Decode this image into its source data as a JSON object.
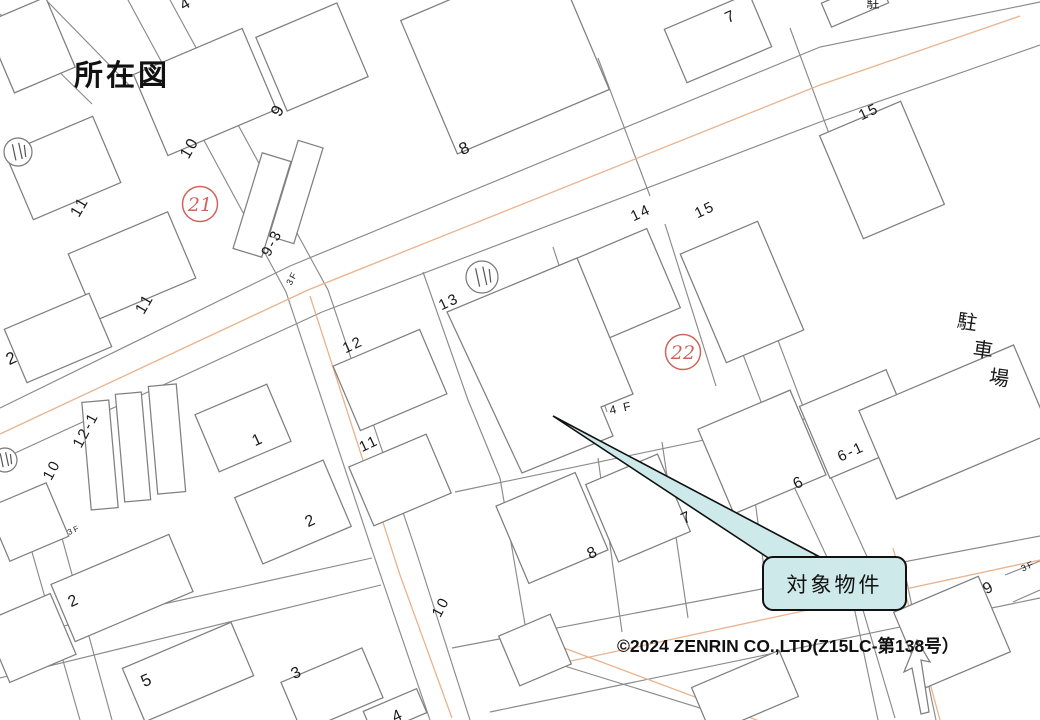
{
  "title": "所在図",
  "copyright": "©2024 ZENRIN CO.,LTD(Z15LC-第138号）",
  "callout": {
    "label": "対象物件",
    "box": {
      "x": 762,
      "y": 556,
      "w": 141,
      "h": 51
    },
    "arrow": [
      [
        553,
        416
      ],
      [
        818,
        556
      ],
      [
        776,
        563
      ]
    ]
  },
  "colors": {
    "line": "#8a8a8a",
    "building": "#7f7f7f",
    "road_center": "#e8b38e",
    "red": "#d0635a",
    "label": "#1a1a1a",
    "callout_fill": "#cde9e9"
  },
  "red_circles": [
    {
      "label": "21",
      "x": 200,
      "y": 204
    },
    {
      "label": "22",
      "x": 683,
      "y": 352
    }
  ],
  "symbols": [
    {
      "x": 18,
      "y": 152,
      "r": 14
    },
    {
      "x": 5,
      "y": 460,
      "r": 12
    },
    {
      "x": 482,
      "y": 277,
      "r": 16
    }
  ],
  "labels": [
    {
      "t": "4",
      "x": 186,
      "y": 4,
      "r": -30,
      "s": 16
    },
    {
      "t": "9",
      "x": 278,
      "y": 110,
      "r": -60,
      "s": 17
    },
    {
      "t": "10",
      "x": 190,
      "y": 148,
      "r": -60,
      "s": 16
    },
    {
      "t": "11",
      "x": 80,
      "y": 207,
      "r": -60,
      "s": 16
    },
    {
      "t": "11",
      "x": 145,
      "y": 304,
      "r": -60,
      "s": 16
    },
    {
      "t": "9-3",
      "x": 272,
      "y": 243,
      "r": -62,
      "s": 15
    },
    {
      "t": "3F",
      "x": 292,
      "y": 278,
      "r": -62,
      "s": 9
    },
    {
      "t": "2",
      "x": 12,
      "y": 358,
      "r": -25,
      "s": 17
    },
    {
      "t": "8",
      "x": 465,
      "y": 148,
      "r": -25,
      "s": 17
    },
    {
      "t": "7",
      "x": 731,
      "y": 17,
      "r": -25,
      "s": 16
    },
    {
      "t": "駐",
      "x": 874,
      "y": 3,
      "r": 0,
      "s": 13
    },
    {
      "t": "15",
      "x": 869,
      "y": 112,
      "r": -25,
      "s": 15
    },
    {
      "t": "14",
      "x": 641,
      "y": 213,
      "r": -25,
      "s": 15
    },
    {
      "t": "15",
      "x": 705,
      "y": 210,
      "r": -25,
      "s": 15
    },
    {
      "t": "13",
      "x": 449,
      "y": 302,
      "r": -25,
      "s": 15
    },
    {
      "t": "12",
      "x": 353,
      "y": 345,
      "r": -25,
      "s": 15
    },
    {
      "t": "11",
      "x": 369,
      "y": 444,
      "r": -25,
      "s": 15
    },
    {
      "t": "4 F",
      "x": 621,
      "y": 408,
      "r": -12,
      "s": 12
    },
    {
      "t": "1",
      "x": 258,
      "y": 440,
      "r": -25,
      "s": 16
    },
    {
      "t": "12-1",
      "x": 86,
      "y": 430,
      "r": -62,
      "s": 15
    },
    {
      "t": "10",
      "x": 52,
      "y": 470,
      "r": -62,
      "s": 15
    },
    {
      "t": "3F",
      "x": 74,
      "y": 530,
      "r": -25,
      "s": 8
    },
    {
      "t": "2",
      "x": 311,
      "y": 521,
      "r": -25,
      "s": 16
    },
    {
      "t": "2",
      "x": 74,
      "y": 601,
      "r": -25,
      "s": 16
    },
    {
      "t": "5",
      "x": 147,
      "y": 680,
      "r": -25,
      "s": 17
    },
    {
      "t": "3",
      "x": 297,
      "y": 673,
      "r": -25,
      "s": 16
    },
    {
      "t": "4",
      "x": 398,
      "y": 716,
      "r": -25,
      "s": 16
    },
    {
      "t": "10",
      "x": 441,
      "y": 607,
      "r": -62,
      "s": 15
    },
    {
      "t": "8",
      "x": 593,
      "y": 553,
      "r": -25,
      "s": 16
    },
    {
      "t": "7",
      "x": 687,
      "y": 518,
      "r": -25,
      "s": 16
    },
    {
      "t": "6",
      "x": 799,
      "y": 483,
      "r": -25,
      "s": 16
    },
    {
      "t": "6-1",
      "x": 851,
      "y": 452,
      "r": -25,
      "s": 15
    },
    {
      "t": "9",
      "x": 989,
      "y": 588,
      "r": -28,
      "s": 16
    },
    {
      "t": "3F",
      "x": 1028,
      "y": 566,
      "r": -25,
      "s": 9
    },
    {
      "t": "駐",
      "x": 968,
      "y": 323,
      "r": 8,
      "s": 20
    },
    {
      "t": "車",
      "x": 984,
      "y": 351,
      "r": 8,
      "s": 20
    },
    {
      "t": "場",
      "x": 1000,
      "y": 379,
      "r": 8,
      "s": 20
    }
  ],
  "map": {
    "lines": [
      [
        [
          0,
          408
        ],
        [
          290,
          266
        ],
        [
          820,
          47
        ],
        [
          1040,
          2
        ]
      ],
      [
        [
          0,
          460
        ],
        [
          322,
          312
        ],
        [
          820,
          122
        ],
        [
          1040,
          45
        ]
      ],
      [
        [
          128,
          0
        ],
        [
          286,
          292
        ],
        [
          372,
          550
        ],
        [
          430,
          720
        ]
      ],
      [
        [
          170,
          0
        ],
        [
          328,
          290
        ],
        [
          415,
          548
        ],
        [
          470,
          720
        ]
      ],
      [
        [
          452,
          648
        ],
        [
          1040,
          536
        ]
      ],
      [
        [
          490,
          712
        ],
        [
          1040,
          598
        ]
      ],
      [
        [
          0,
          640
        ],
        [
          372,
          558
        ]
      ],
      [
        [
          0,
          678
        ],
        [
          381,
          585
        ]
      ],
      [
        [
          704,
          252
        ],
        [
          790,
          478
        ],
        [
          840,
          585
        ]
      ],
      [
        [
          740,
          240
        ],
        [
          824,
          462
        ],
        [
          874,
          572
        ]
      ],
      [
        [
          850,
          588
        ],
        [
          878,
          720
        ]
      ],
      [
        [
          906,
          578
        ],
        [
          936,
          720
        ]
      ],
      [
        [
          0,
          14
        ],
        [
          92,
          104
        ]
      ],
      [
        [
          46,
          0
        ],
        [
          132,
          88
        ]
      ],
      [
        [
          30,
          545
        ],
        [
          80,
          720
        ]
      ],
      [
        [
          62,
          538
        ],
        [
          112,
          720
        ]
      ],
      [
        [
          545,
          660
        ],
        [
          745,
          722
        ]
      ],
      [
        [
          423,
          272
        ],
        [
          468,
          400
        ],
        [
          500,
          478
        ]
      ],
      [
        [
          553,
          247
        ],
        [
          607,
          412
        ]
      ],
      [
        [
          665,
          224
        ],
        [
          716,
          386
        ]
      ],
      [
        [
          455,
          492
        ],
        [
          905,
          398
        ]
      ],
      [
        [
          500,
          478
        ],
        [
          528,
          642
        ]
      ],
      [
        [
          598,
          458
        ],
        [
          622,
          632
        ]
      ],
      [
        [
          662,
          442
        ],
        [
          688,
          618
        ]
      ],
      [
        [
          745,
          425
        ],
        [
          768,
          598
        ]
      ],
      [
        [
          598,
          58
        ],
        [
          650,
          196
        ]
      ],
      [
        [
          790,
          28
        ],
        [
          838,
          158
        ]
      ],
      [
        [
          1005,
          575
        ],
        [
          1040,
          561
        ]
      ],
      [
        [
          1013,
          602
        ],
        [
          1040,
          590
        ]
      ],
      [
        [
          860,
          600
        ],
        [
          895,
          718
        ]
      ]
    ],
    "center_lines": [
      [
        [
          0,
          434
        ],
        [
          308,
          290
        ],
        [
          820,
          85
        ],
        [
          1020,
          16
        ]
      ],
      [
        [
          310,
          296
        ],
        [
          400,
          575
        ],
        [
          452,
          718
        ]
      ],
      [
        [
          520,
          672
        ],
        [
          1040,
          560
        ]
      ],
      [
        [
          556,
          645
        ],
        [
          762,
          722
        ]
      ],
      [
        [
          893,
          548
        ],
        [
          940,
          720
        ]
      ]
    ],
    "buildings": [
      {
        "cx": 205,
        "cy": 92,
        "w": 118,
        "h": 88,
        "r": -23
      },
      {
        "cx": 312,
        "cy": 57,
        "w": 88,
        "h": 80,
        "r": -23
      },
      {
        "cx": 63,
        "cy": 168,
        "w": 95,
        "h": 72,
        "r": -23
      },
      {
        "cx": 132,
        "cy": 266,
        "w": 108,
        "h": 72,
        "r": -23
      },
      {
        "cx": 262,
        "cy": 205,
        "w": 30,
        "h": 100,
        "r": 17
      },
      {
        "cx": 296,
        "cy": 192,
        "w": 26,
        "h": 100,
        "r": 17
      },
      {
        "cx": 58,
        "cy": 338,
        "w": 92,
        "h": 58,
        "r": -23
      },
      {
        "cx": 30,
        "cy": 45,
        "w": 66,
        "h": 76,
        "r": -23
      },
      {
        "cx": 505,
        "cy": 55,
        "w": 165,
        "h": 145,
        "r": -23
      },
      {
        "cx": 718,
        "cy": 38,
        "w": 92,
        "h": 58,
        "r": -23
      },
      {
        "cx": 855,
        "cy": 3,
        "w": 62,
        "h": 26,
        "r": -23
      },
      {
        "cx": 882,
        "cy": 170,
        "w": 88,
        "h": 112,
        "r": -23
      },
      {
        "cx": 612,
        "cy": 290,
        "w": 112,
        "h": 86,
        "r": -23
      },
      {
        "cx": 742,
        "cy": 292,
        "w": 84,
        "h": 118,
        "r": -23
      },
      {
        "cx": 390,
        "cy": 380,
        "w": 94,
        "h": 70,
        "r": -23
      },
      {
        "cx": 400,
        "cy": 480,
        "w": 84,
        "h": 64,
        "r": -23
      },
      {
        "cx": 100,
        "cy": 455,
        "w": 27,
        "h": 108,
        "r": -5
      },
      {
        "cx": 133,
        "cy": 447,
        "w": 26,
        "h": 108,
        "r": -5
      },
      {
        "cx": 167,
        "cy": 439,
        "w": 28,
        "h": 108,
        "r": -5
      },
      {
        "cx": 243,
        "cy": 428,
        "w": 78,
        "h": 62,
        "r": -23
      },
      {
        "cx": 293,
        "cy": 512,
        "w": 96,
        "h": 72,
        "r": -23
      },
      {
        "cx": 122,
        "cy": 588,
        "w": 128,
        "h": 62,
        "r": -23
      },
      {
        "cx": 188,
        "cy": 672,
        "w": 118,
        "h": 58,
        "r": -23
      },
      {
        "cx": 332,
        "cy": 690,
        "w": 88,
        "h": 54,
        "r": -23
      },
      {
        "cx": 28,
        "cy": 522,
        "w": 64,
        "h": 58,
        "r": -23
      },
      {
        "cx": 30,
        "cy": 638,
        "w": 72,
        "h": 66,
        "r": -23
      },
      {
        "cx": 552,
        "cy": 528,
        "w": 86,
        "h": 84,
        "r": -23
      },
      {
        "cx": 638,
        "cy": 508,
        "w": 78,
        "h": 84,
        "r": -23
      },
      {
        "cx": 762,
        "cy": 452,
        "w": 100,
        "h": 92,
        "r": -23
      },
      {
        "cx": 858,
        "cy": 424,
        "w": 94,
        "h": 78,
        "r": -23
      },
      {
        "cx": 535,
        "cy": 650,
        "w": 56,
        "h": 54,
        "r": -23
      },
      {
        "cx": 952,
        "cy": 632,
        "w": 92,
        "h": 82,
        "r": -23
      },
      {
        "cx": 955,
        "cy": 422,
        "w": 168,
        "h": 96,
        "r": -23
      },
      {
        "cx": 395,
        "cy": 712,
        "w": 58,
        "h": 26,
        "r": -23
      },
      {
        "cx": 745,
        "cy": 692,
        "w": 95,
        "h": 50,
        "r": -23
      }
    ],
    "polygons": [
      {
        "name": "target-building",
        "pts": [
          [
            447,
            312
          ],
          [
            577,
            258
          ],
          [
            633,
            394
          ],
          [
            601,
            407
          ],
          [
            613,
            436
          ],
          [
            522,
            473
          ]
        ]
      },
      {
        "name": "one-way-arrow",
        "pts": [
          [
            921,
            714
          ],
          [
            912,
            668
          ],
          [
            904,
            672
          ],
          [
            917,
            640
          ],
          [
            930,
            662
          ],
          [
            921,
            660
          ],
          [
            929,
            712
          ]
        ]
      }
    ]
  }
}
